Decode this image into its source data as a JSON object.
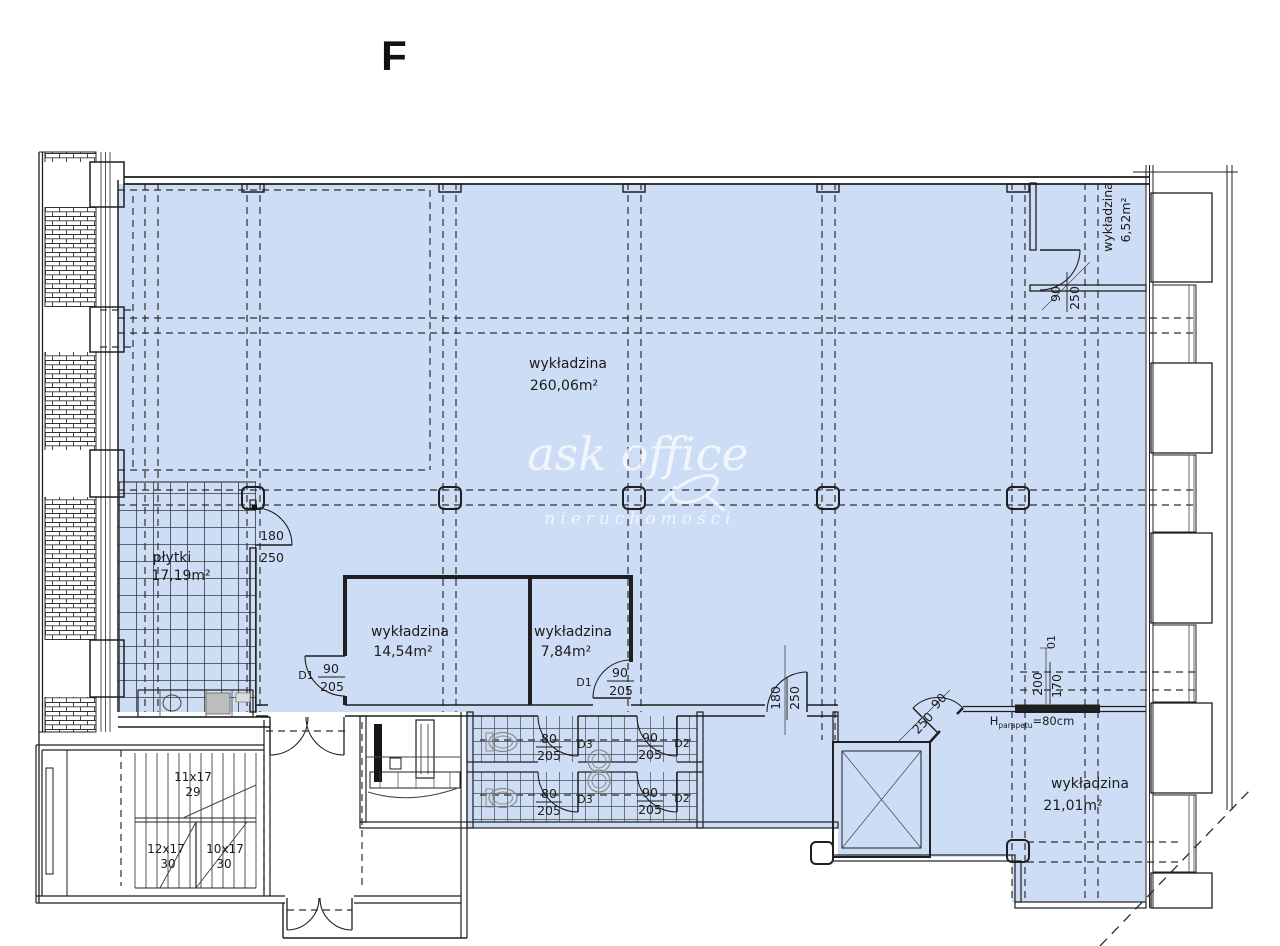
{
  "letter": "F",
  "watermark": {
    "brand": "ask office",
    "sub": "nieruchomości"
  },
  "rooms": {
    "main": {
      "name": "wykładzina",
      "area": "260,06m²"
    },
    "plytki": {
      "name": "płytki",
      "area": "17,19m²"
    },
    "office_a": {
      "name": "wykładzina",
      "area": "14,54m²"
    },
    "office_b": {
      "name": "wykładzina",
      "area": "7,84m²"
    },
    "right": {
      "name": "wykładzina",
      "area": "21,01m²"
    },
    "top_right": {
      "name": "wykładzina",
      "area": "6,52m²"
    }
  },
  "doors": {
    "plytki": {
      "width": "180",
      "height": "250"
    },
    "d1a": {
      "tag": "D1",
      "width": "90",
      "height": "205"
    },
    "d1b": {
      "tag": "D1",
      "width": "90",
      "height": "205"
    },
    "d3a": {
      "tag": "D3",
      "width": "80",
      "height": "205"
    },
    "d2a": {
      "tag": "D2",
      "width": "90",
      "height": "205"
    },
    "d3b": {
      "tag": "D3",
      "width": "80",
      "height": "205"
    },
    "d2b": {
      "tag": "D2",
      "width": "90",
      "height": "205"
    },
    "corridor": {
      "width": "180",
      "height": "250"
    },
    "diagonal": {
      "width": "90",
      "height": "250"
    },
    "top_right": {
      "width": "90",
      "height": "250"
    }
  },
  "annotations": {
    "opening": {
      "tag": "01",
      "width": "200",
      "height": "170"
    },
    "sill": {
      "symbol": "H",
      "subscript": "parapetu",
      "value": "=80cm"
    }
  },
  "stairs": {
    "flight_top": {
      "treads": "11x17",
      "label": "29"
    },
    "flight_left": {
      "treads": "12x17",
      "label": "30"
    },
    "flight_right": {
      "treads": "10x17",
      "label": "30"
    }
  },
  "colors": {
    "floor": "#cdddf5",
    "line": "#1f1f1f",
    "watermark": "#ffffff"
  }
}
